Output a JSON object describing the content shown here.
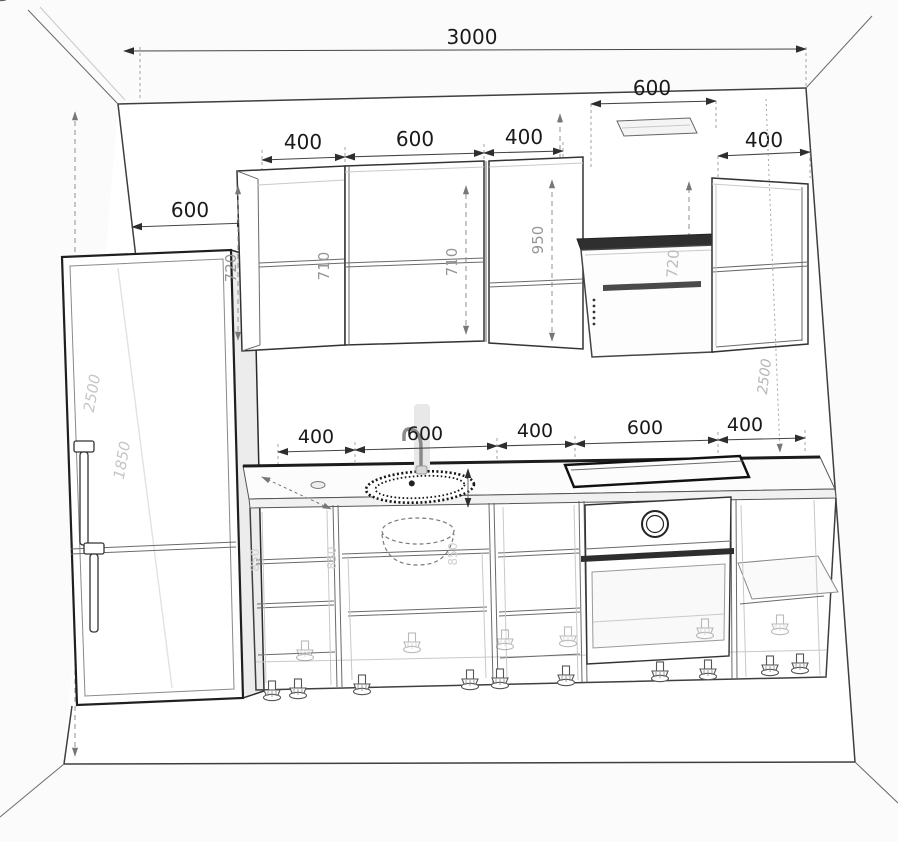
{
  "colors": {
    "background": "#ffffff",
    "line": "#3f3f3f",
    "dim_text": "#1a1a1a",
    "height_label": "#969696",
    "faint_label": "#c6c6c6"
  },
  "dims": {
    "total_width": "3000",
    "hood_offset": "600",
    "upper_right_width": "400",
    "upper_row": {
      "a": "400",
      "b": "600",
      "c": "400"
    },
    "left_offset": "600",
    "heights": {
      "cab_a": "720",
      "cab_a_inner": "710",
      "cab_b": "710",
      "cab_c": "950",
      "hood": "720"
    },
    "right_wall_height": "2500",
    "fridge_height": "2500",
    "fridge_door_height": "1850",
    "lower_row": {
      "a": "400",
      "b": "600",
      "c": "400",
      "d": "600",
      "e": "400"
    },
    "base_heights": {
      "h1": "850",
      "h2": "850",
      "h3": "850"
    }
  }
}
